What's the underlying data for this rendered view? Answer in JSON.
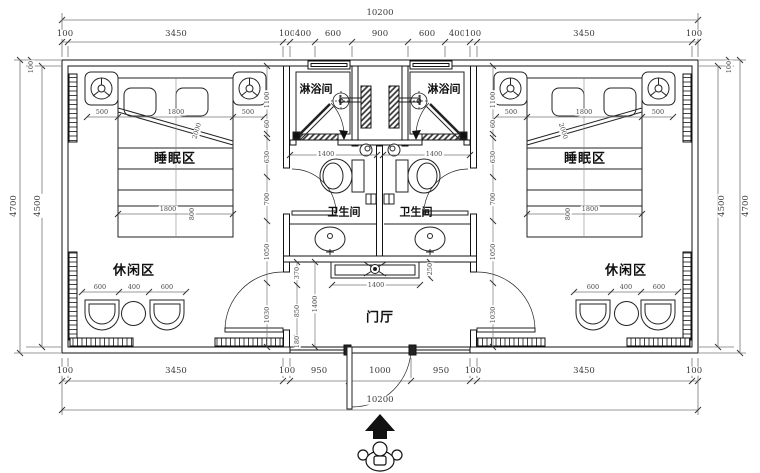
{
  "drawing_type": "hotel-guest-room floor plan",
  "labels": {
    "shower_left": "淋浴间",
    "shower_right": "淋浴间",
    "wc_left": "卫生间",
    "wc_right": "卫生间",
    "sleep_left": "睡眠区",
    "sleep_right": "睡眠区",
    "leisure_left": "休闲区",
    "leisure_right": "休闲区",
    "hall": "门厅"
  },
  "dims": {
    "overall_top": "10200",
    "overall_bottom": "10200",
    "top_chain": [
      "100",
      "3450",
      "100",
      "400",
      "600",
      "900",
      "600",
      "400",
      "100",
      "3450",
      "100"
    ],
    "bottom_left_chain": [
      "100",
      "3450",
      "100"
    ],
    "bottom_center_chain": [
      "950",
      "1000",
      "950"
    ],
    "bottom_right_chain": [
      "100",
      "3450",
      "100"
    ],
    "side_left": {
      "outer": "4700",
      "inner": "4500",
      "wall_top": "100"
    },
    "side_right": {
      "outer": "4700",
      "inner": "4500",
      "wall_top": "100"
    },
    "bed_left": {
      "chain": [
        "500",
        "1800",
        "500"
      ],
      "foot": "1800",
      "foot_depth": "800",
      "diag": "2000"
    },
    "bed_right": {
      "chain": [
        "500",
        "1800",
        "500"
      ],
      "foot": "1800",
      "foot_depth": "800",
      "diag": "2000"
    },
    "inner_left_chain": [
      "1100",
      "60",
      "630",
      "700",
      "1050",
      "1030"
    ],
    "inner_right_chain": [
      "1100",
      "60",
      "630",
      "700",
      "1050",
      "1030"
    ],
    "bath_left_width": "1400",
    "bath_right_width": "1400",
    "leisure_left_chain": [
      "600",
      "400",
      "600"
    ],
    "leisure_right_chain": [
      "600",
      "400",
      "600"
    ],
    "hall_chain": [
      "370",
      "850",
      "180"
    ],
    "hall_depth": "1400",
    "console_width": "1400",
    "console_depth": "250"
  },
  "colors": {
    "line": "#1a1a1a",
    "dim_line": "#666666",
    "dim_text": "#4a4a4a",
    "paper": "#ffffff"
  }
}
